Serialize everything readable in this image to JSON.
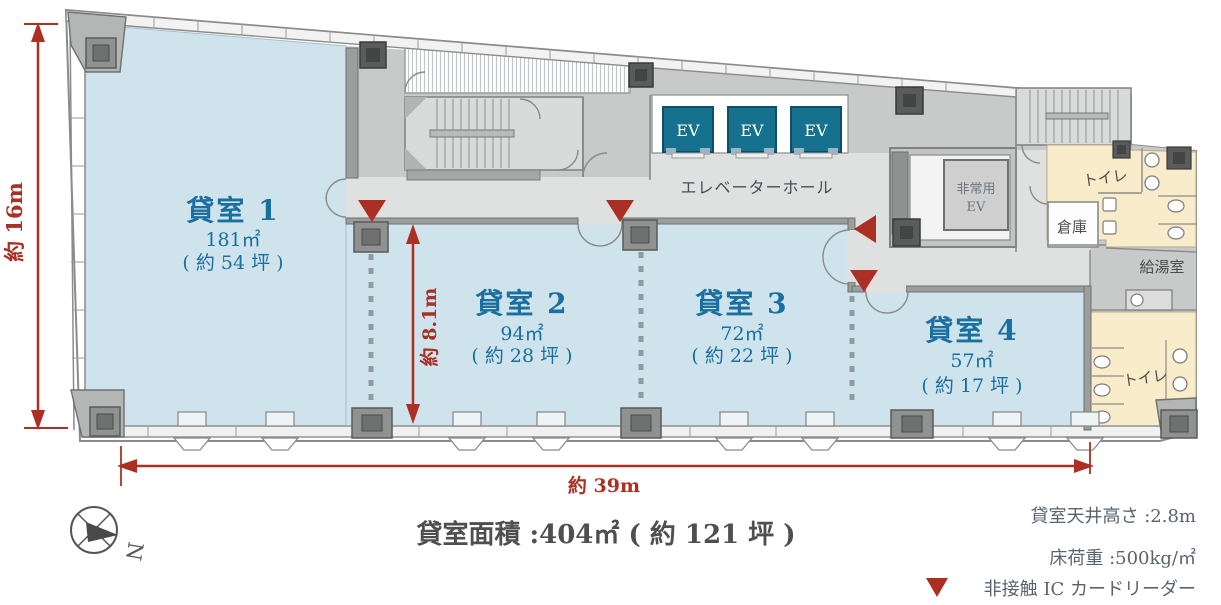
{
  "rooms": [
    {
      "name": "貸室 1",
      "area": "181㎡",
      "tsubo": "( 約 54 坪 )"
    },
    {
      "name": "貸室 2",
      "area": "94㎡",
      "tsubo": "( 約 28 坪 )"
    },
    {
      "name": "貸室 3",
      "area": "72㎡",
      "tsubo": "( 約 22 坪 )"
    },
    {
      "name": "貸室 4",
      "area": "57㎡",
      "tsubo": "( 約 17 坪 )"
    }
  ],
  "core": {
    "ev_label": "EV",
    "elevator_hall": "エレベーターホール",
    "emergency_ev_line1": "非常用",
    "emergency_ev_line2": "EV",
    "toilet": "トイレ",
    "storage": "倉庫",
    "kitchenette": "給湯室"
  },
  "dimensions": {
    "total_width": "約 39m",
    "total_depth": "約 16m",
    "room_depth": "約 8.1m"
  },
  "summary": {
    "total_area": "貸室面積 :404㎡ ( 約 121 坪 )"
  },
  "specs": {
    "ceiling_height": "貸室天井高さ :2.8m",
    "floor_load": "床荷重 :500kg/㎡"
  },
  "legend": {
    "ic_card_reader": "非接触 IC カードリーダー"
  },
  "compass": {
    "north_label": "N"
  },
  "colors": {
    "accent_red": "#ab2f23",
    "room_fill": "#cfe3ed",
    "room_text": "#1a6f9e",
    "corridor_fill": "#dfe0e0",
    "core_fill": "#c8c9c9",
    "ev_fill": "#16718f",
    "toilet_fill": "#f8ecca"
  }
}
